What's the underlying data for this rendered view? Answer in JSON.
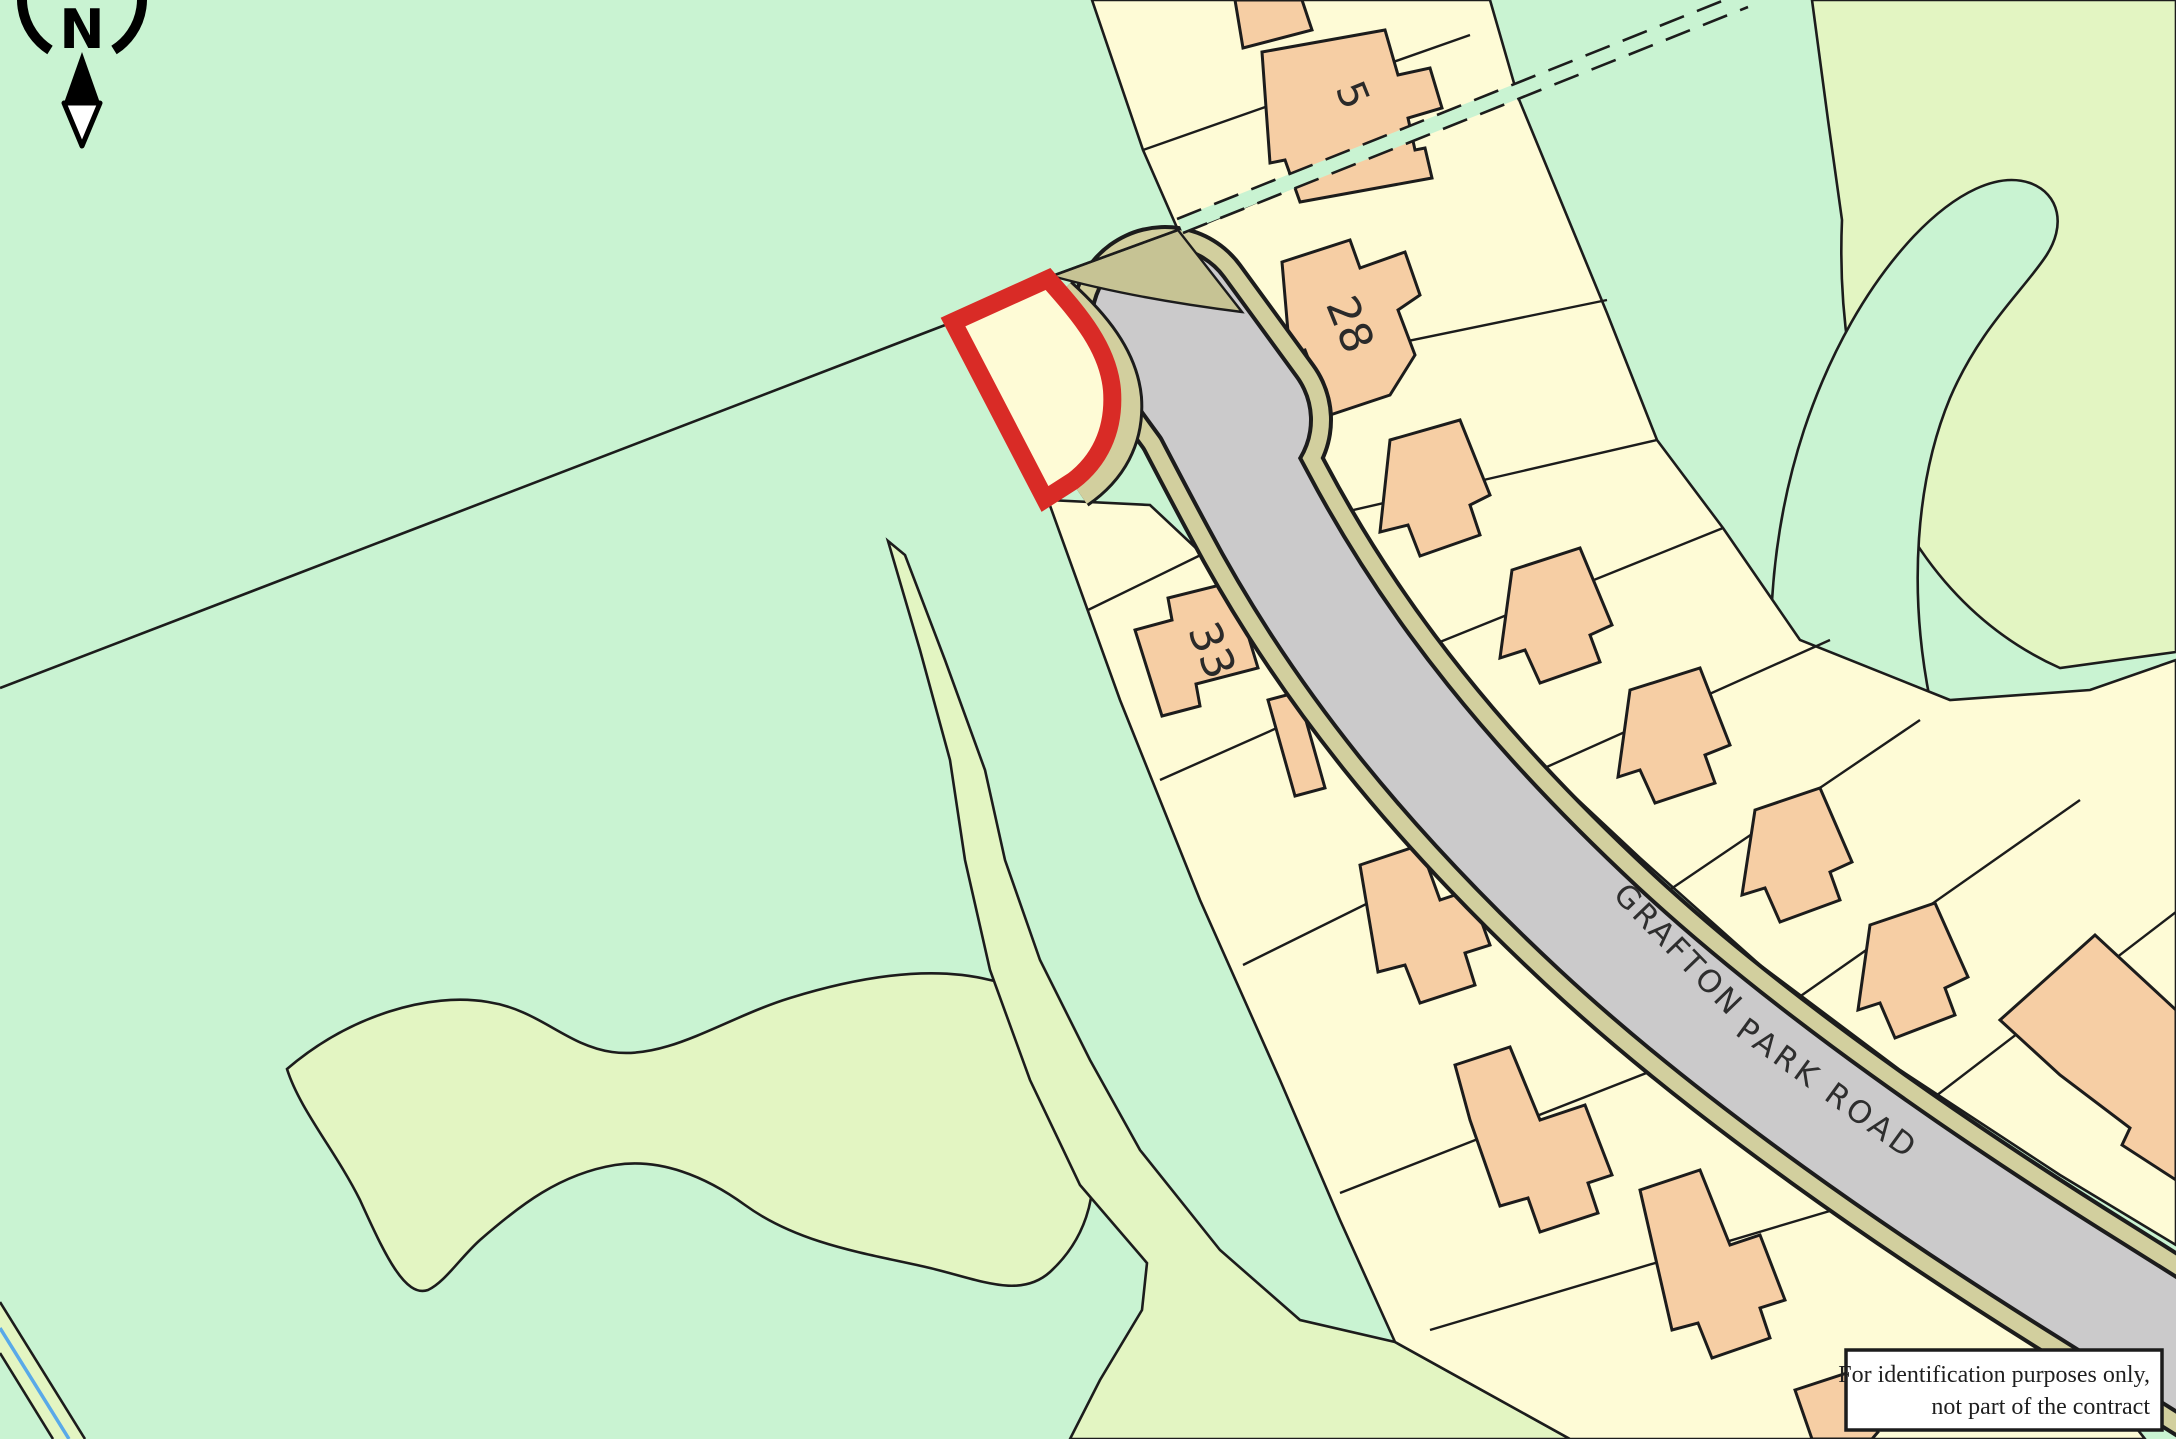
{
  "map": {
    "compass_label": "N",
    "road_name_part1": "GRAFTON",
    "road_name_part2": "PARK ROAD",
    "house_numbers": {
      "n5": "5",
      "n28": "28",
      "n33": "33"
    },
    "disclaimer_line1": "For identification purposes only,",
    "disclaimer_line2": "not part of the contract"
  },
  "colors": {
    "field_mint": "#c9f3d2",
    "field_yellow_green": "#e3f5c2",
    "parcel_cream": "#fefbd6",
    "building_salmon": "#f6cea4",
    "road_grey": "#cbcacb",
    "road_verge": "#d2cf9e",
    "verge_dark": "#c6c394",
    "plot_outline_red": "#d92b26",
    "stream_blue": "#59a9e8",
    "line_black": "#1c1c1c",
    "disclaimer_bg": "#ffffff"
  }
}
